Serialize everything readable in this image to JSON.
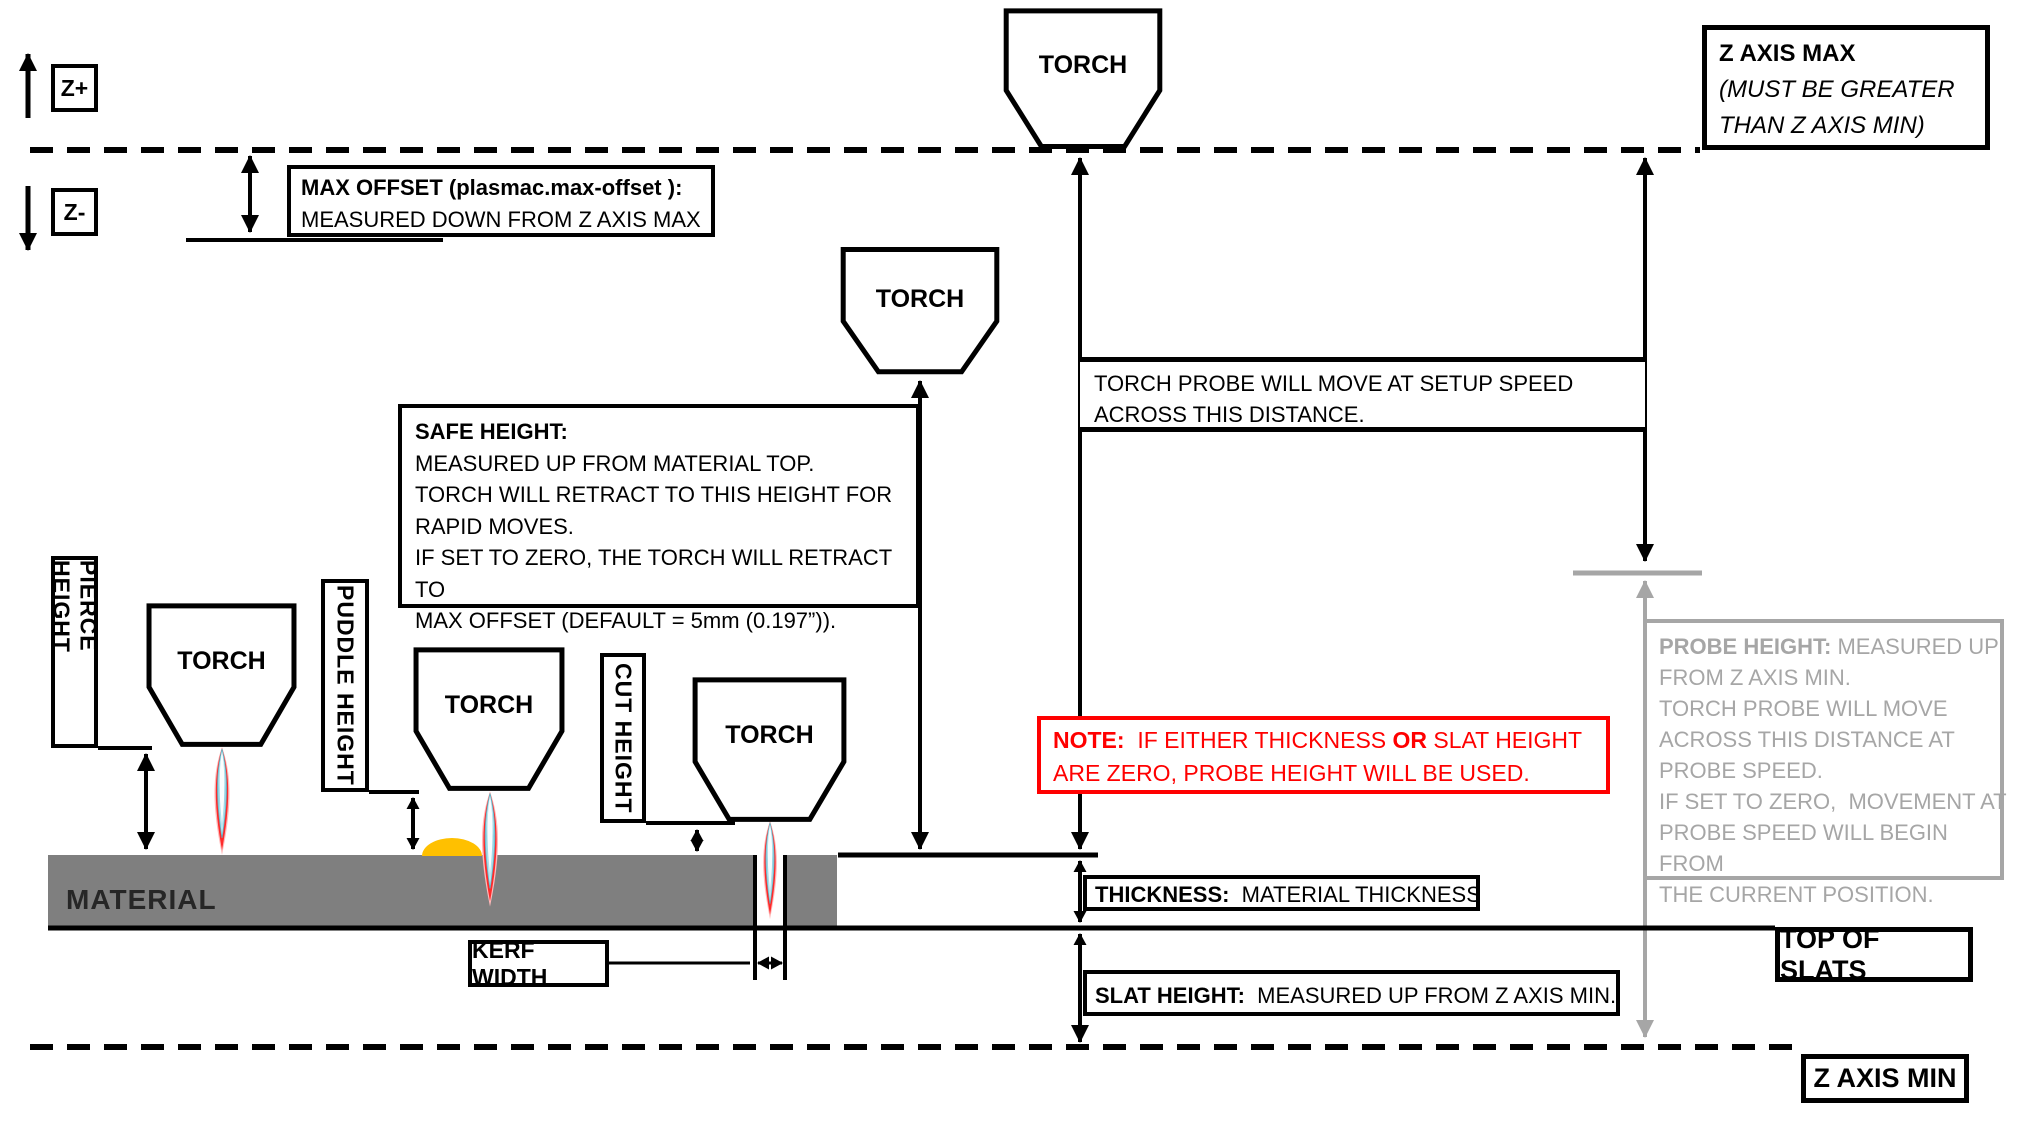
{
  "diagram": {
    "axis": {
      "z_plus": "Z+",
      "z_minus": "Z-"
    },
    "torch_label": "TORCH",
    "z_axis_max_box": {
      "line1": "Z AXIS MAX",
      "line2": "(MUST BE GREATER",
      "line3": "THAN Z AXIS MIN)"
    },
    "max_offset_box": {
      "line1": "MAX OFFSET (plasmac.max-offset ):",
      "line2": "MEASURED DOWN FROM Z AXIS MAX"
    },
    "torch_probe_box": {
      "line1": "TORCH PROBE WILL MOVE AT SETUP SPEED",
      "line2": "ACROSS THIS DISTANCE."
    },
    "safe_height_box": {
      "title": "SAFE HEIGHT:",
      "lines": [
        "MEASURED UP FROM MATERIAL TOP.",
        "TORCH WILL RETRACT TO THIS HEIGHT FOR",
        "RAPID MOVES.",
        "IF SET TO ZERO, THE TORCH WILL RETRACT TO",
        "MAX OFFSET (DEFAULT = 5mm (0.197”))."
      ]
    },
    "height_labels": {
      "pierce": "PIERCE HEIGHT",
      "puddle": "PUDDLE HEIGHT",
      "cut": "CUT HEIGHT"
    },
    "material_label": "MATERIAL",
    "kerf_width_label": "KERF WIDTH",
    "note_box": {
      "bold1": "NOTE:",
      "text1": "  IF EITHER THICKNESS ",
      "bold2": "OR",
      "text2": " SLAT HEIGHT",
      "line2": "ARE ZERO, PROBE HEIGHT WILL BE USED."
    },
    "thickness_box": {
      "bold": "THICKNESS:",
      "text": "  MATERIAL THICKNESS"
    },
    "slat_height_box": {
      "bold": "SLAT HEIGHT:",
      "text": "  MEASURED UP FROM Z AXIS MIN."
    },
    "probe_height_box": {
      "bold": "PROBE HEIGHT:",
      "text": " MEASURED UP",
      "lines": [
        "FROM Z AXIS MIN.",
        "TORCH PROBE WILL MOVE",
        "ACROSS THIS DISTANCE AT",
        "PROBE SPEED.",
        "IF SET TO ZERO,  MOVEMENT AT",
        "PROBE SPEED WILL BEGIN FROM",
        "THE CURRENT POSITION."
      ]
    },
    "top_of_slats_label": "TOP OF SLATS",
    "z_axis_min_label": "Z AXIS MIN",
    "colors": {
      "note_red": "#FF0000",
      "annotation_gray": "#A6A6A6",
      "material_gray": "#7F7F7F",
      "puddle_orange": "#FFC000"
    }
  }
}
